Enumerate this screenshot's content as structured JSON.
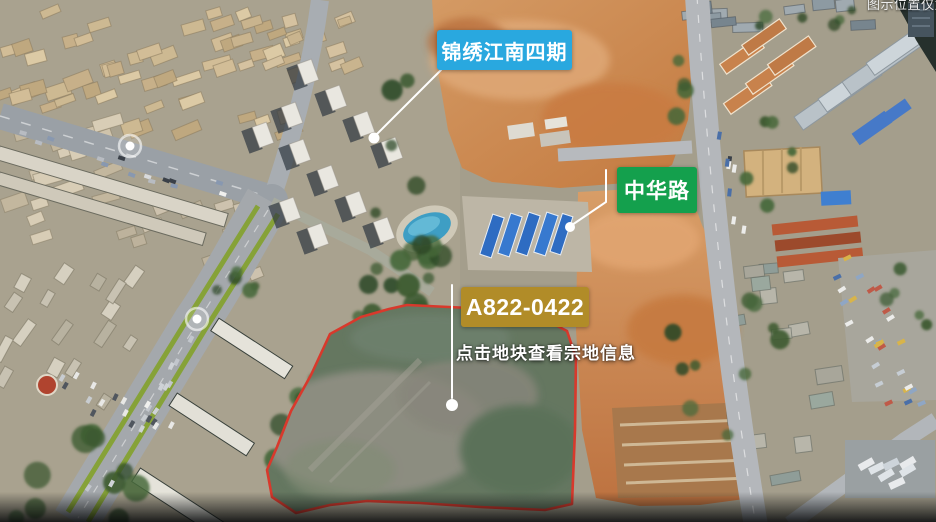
{
  "watermark": {
    "text": "图示位置仅为"
  },
  "map": {
    "type": "aerial-photo",
    "parcel_boundary_color": "#d8392c",
    "marker_color": "#ffffff"
  },
  "labels": {
    "estate": {
      "text": "锦绣江南四期",
      "bg": "#29a8df"
    },
    "road": {
      "text": "中华路",
      "bg": "#14a04d"
    },
    "parcel": {
      "text": "A822-0422",
      "bg": "#b18c28"
    },
    "hint": {
      "text": "点击地块查看宗地信息"
    }
  }
}
